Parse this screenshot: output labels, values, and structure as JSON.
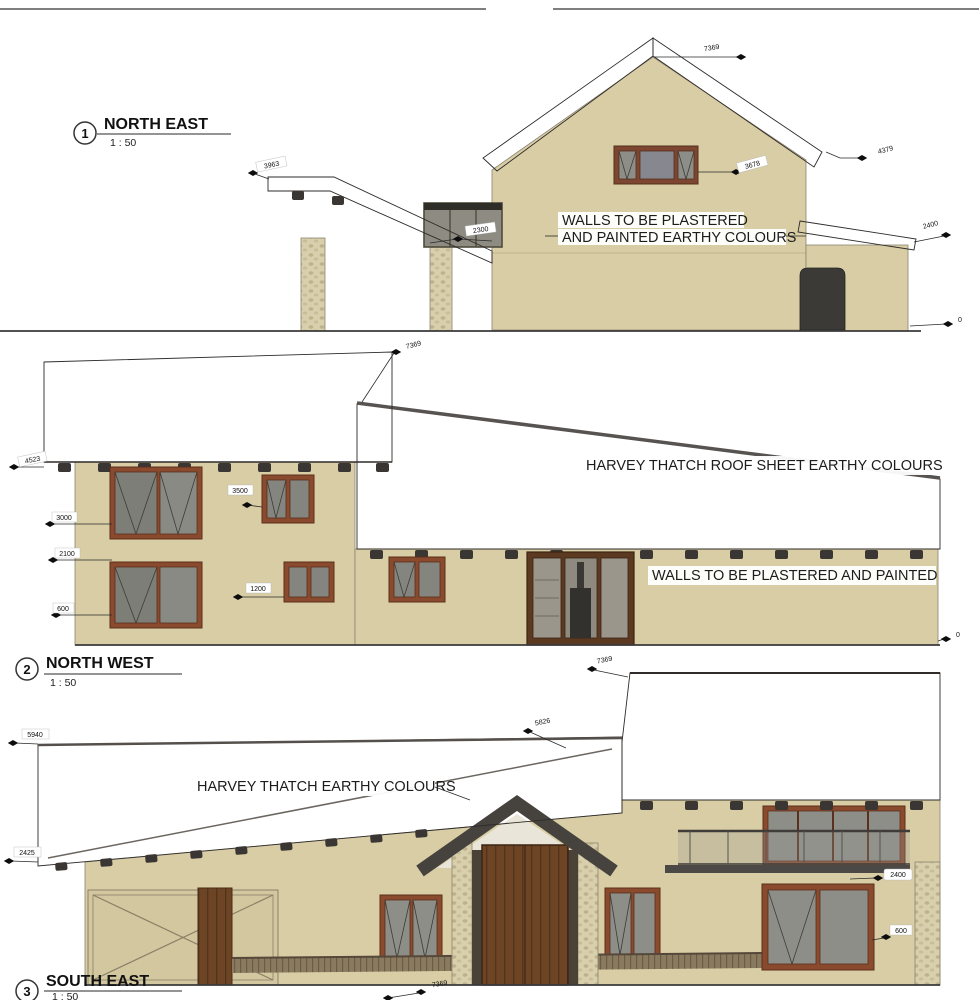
{
  "drawing": {
    "elevations": [
      {
        "number": "1",
        "title": "NORTH EAST",
        "scale": "1 : 50",
        "note_line1": "WALLS TO BE PLASTERED",
        "note_line2": "AND PAINTED EARTHY COLOURS",
        "dims": {
          "ridge": "7369",
          "roof_left": "3963",
          "roof_right": "4379",
          "wall_right": "2400",
          "porch": "2300",
          "window": "3678",
          "ground": "0"
        }
      },
      {
        "number": "2",
        "title": "NORTH WEST",
        "scale": "1 : 50",
        "roof_note": "HARVEY THATCH ROOF SHEET EARTHY COLOURS",
        "wall_note": "WALLS TO BE PLASTERED AND PAINTED",
        "dims": {
          "ridge": "7369",
          "eave": "4523",
          "floor": "3000",
          "mid": "2100",
          "sill": "600",
          "upper_window": "3500",
          "lower_window": "1200",
          "ground": "0"
        }
      },
      {
        "number": "3",
        "title": "SOUTH EAST",
        "scale": "1 : 50",
        "roof_note": "HARVEY THATCH EARTHY COLOURS",
        "dims": {
          "ridge": "7369",
          "roof_edge": "5826",
          "eave_left": "5940",
          "wall_left": "2425",
          "balcony": "2400",
          "sill": "600",
          "width": "7369"
        }
      }
    ],
    "colors": {
      "wall": "#d8cda4",
      "roof": "#4e4a47",
      "window_frame": "#8a4a2e",
      "glass": "#8e8e88",
      "door_wood": "#6e4524",
      "stone": "#d8cfad",
      "line": "#2e2b29"
    }
  }
}
